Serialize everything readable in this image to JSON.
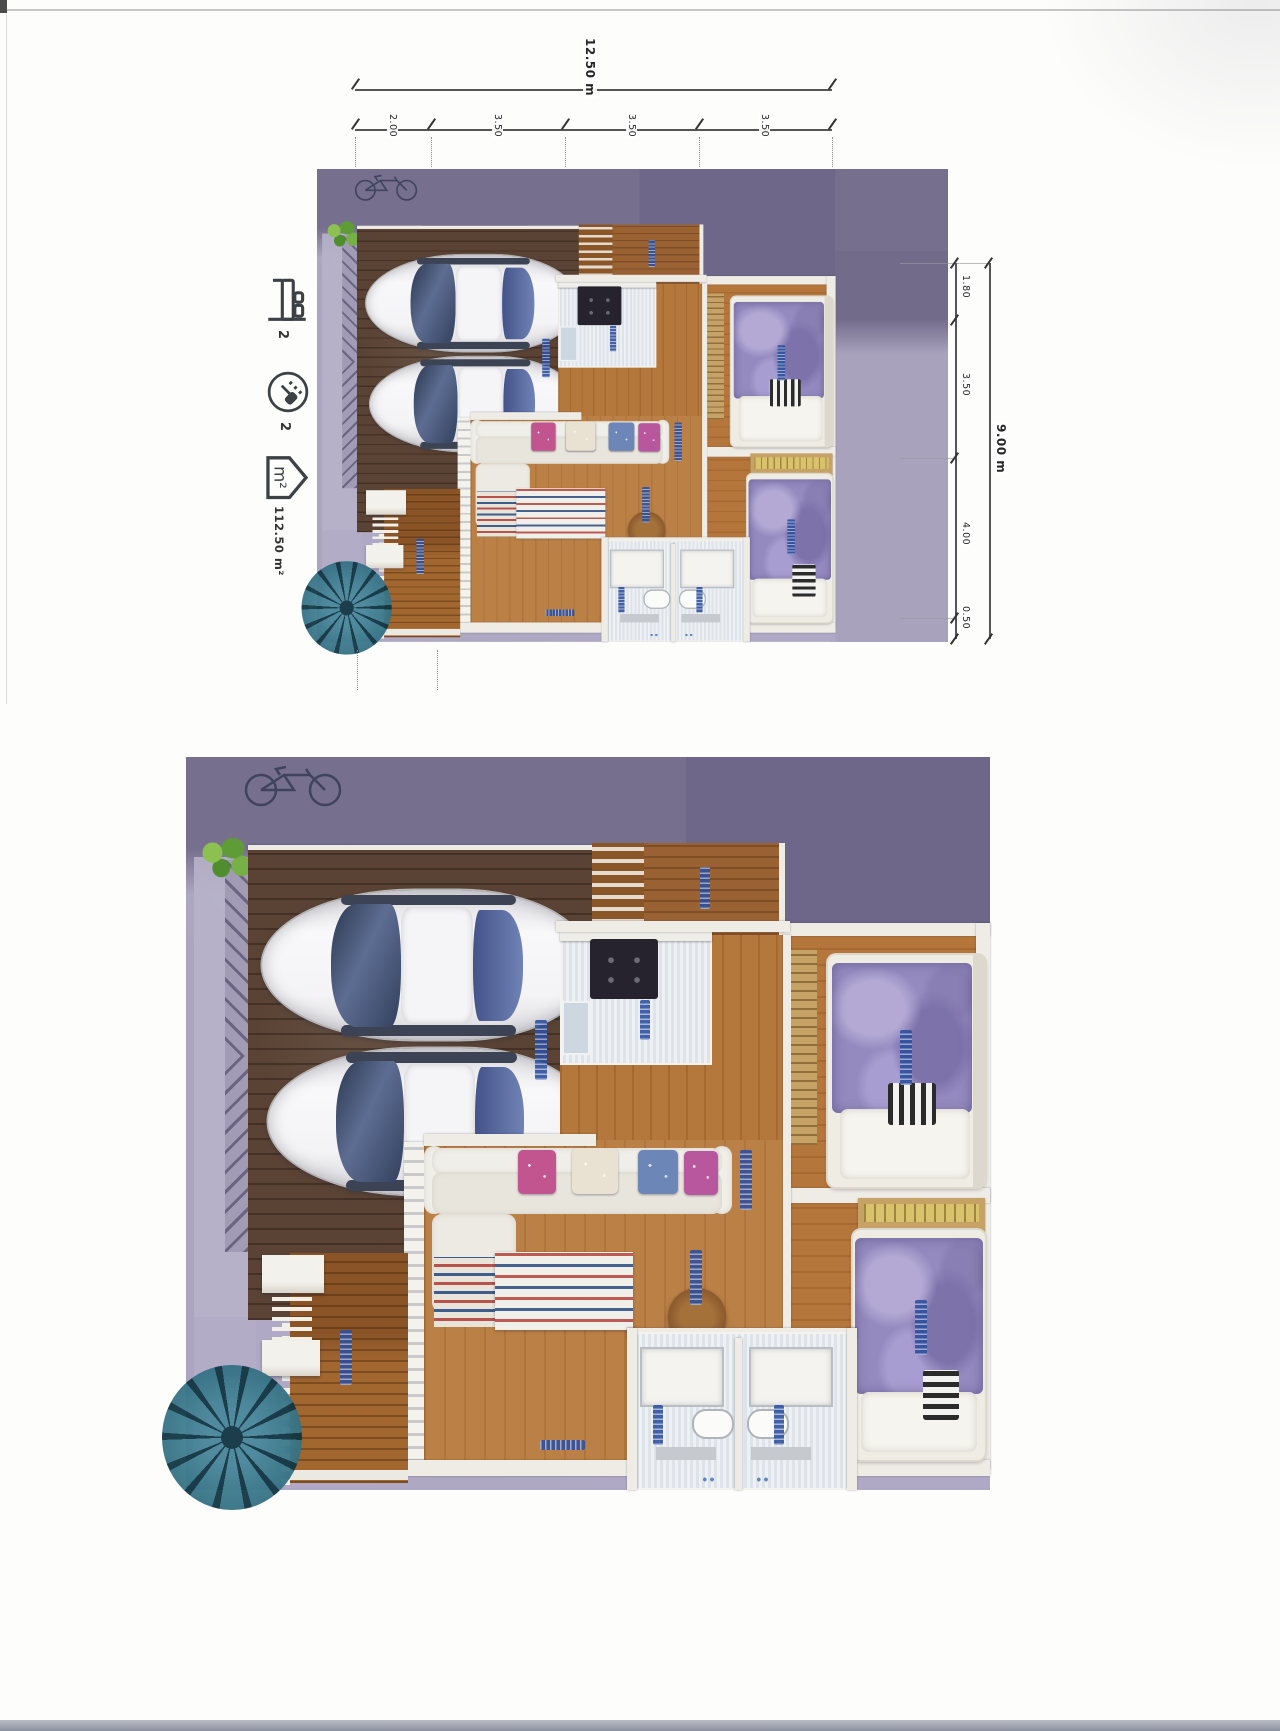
{
  "document": {
    "kind": "scanned floor plan sheet",
    "views": [
      "small annotated plan with dimensions",
      "large rendered plan"
    ]
  },
  "stats": {
    "bedrooms": "2",
    "bathrooms": "2",
    "area": "112.50 m²"
  },
  "dimensions": {
    "width_total": "12.50 m",
    "width_segments": [
      "2.00",
      "3.50",
      "3.50",
      "3.50"
    ],
    "height_total": "9.00 m",
    "height_segments": [
      "1.80",
      "3.50",
      "4.00",
      "0.50"
    ]
  },
  "icons": {
    "bedrooms": "bed-icon",
    "bathrooms": "shower-icon",
    "area": "house-area-icon"
  },
  "colors": {
    "ground_dark": "#776f8e",
    "ground_light": "#aba5c1",
    "garage_wood": "#5a4334",
    "room_wood": "#b5783c",
    "deck_wood": "#a2662f",
    "tile": "#e6e9ec",
    "bed_blanket": "#948ac0",
    "label_blue": "#2d4f9f",
    "palm": "#2e6b7e"
  }
}
